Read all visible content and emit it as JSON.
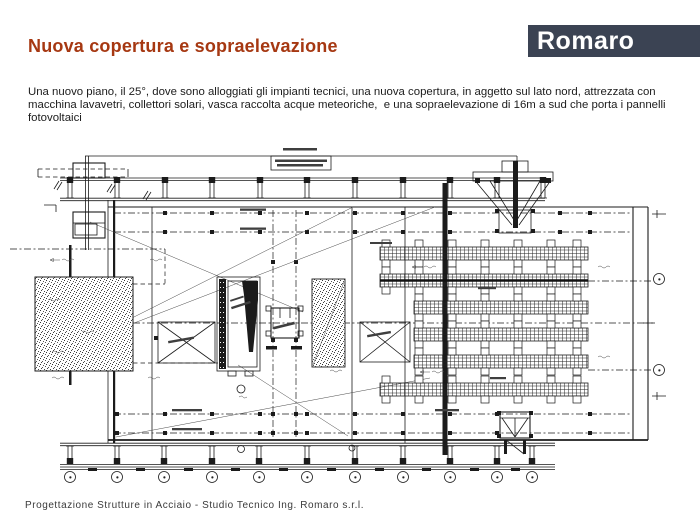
{
  "slide": {
    "title": "Nuova copertura e sopraelevazione",
    "body": "Una nuovo piano, il 25°, dove sono alloggiati gli impianti tecnici, una nuova copertura, in aggetto sul lato nord, attrezzata con macchina lavavetri, collettori solari, vasca raccolta acque meteoriche,  e una sopraelevazione di 16m a sud che porta i pannelli fotovoltaici",
    "footer": "Progettazione Strutture in Acciaio - Studio Tecnico Ing. Romaro s.r.l."
  },
  "logo": {
    "text": "Romaro"
  },
  "colors": {
    "title-color": "#a63812",
    "logo-bg": "#3b4353",
    "logo-fg": "#ffffff",
    "ink": "#1b1b1b"
  },
  "drawing": {
    "grid_bubble_count": 11,
    "pv_panel_rows": 6,
    "labels_legible": false
  }
}
